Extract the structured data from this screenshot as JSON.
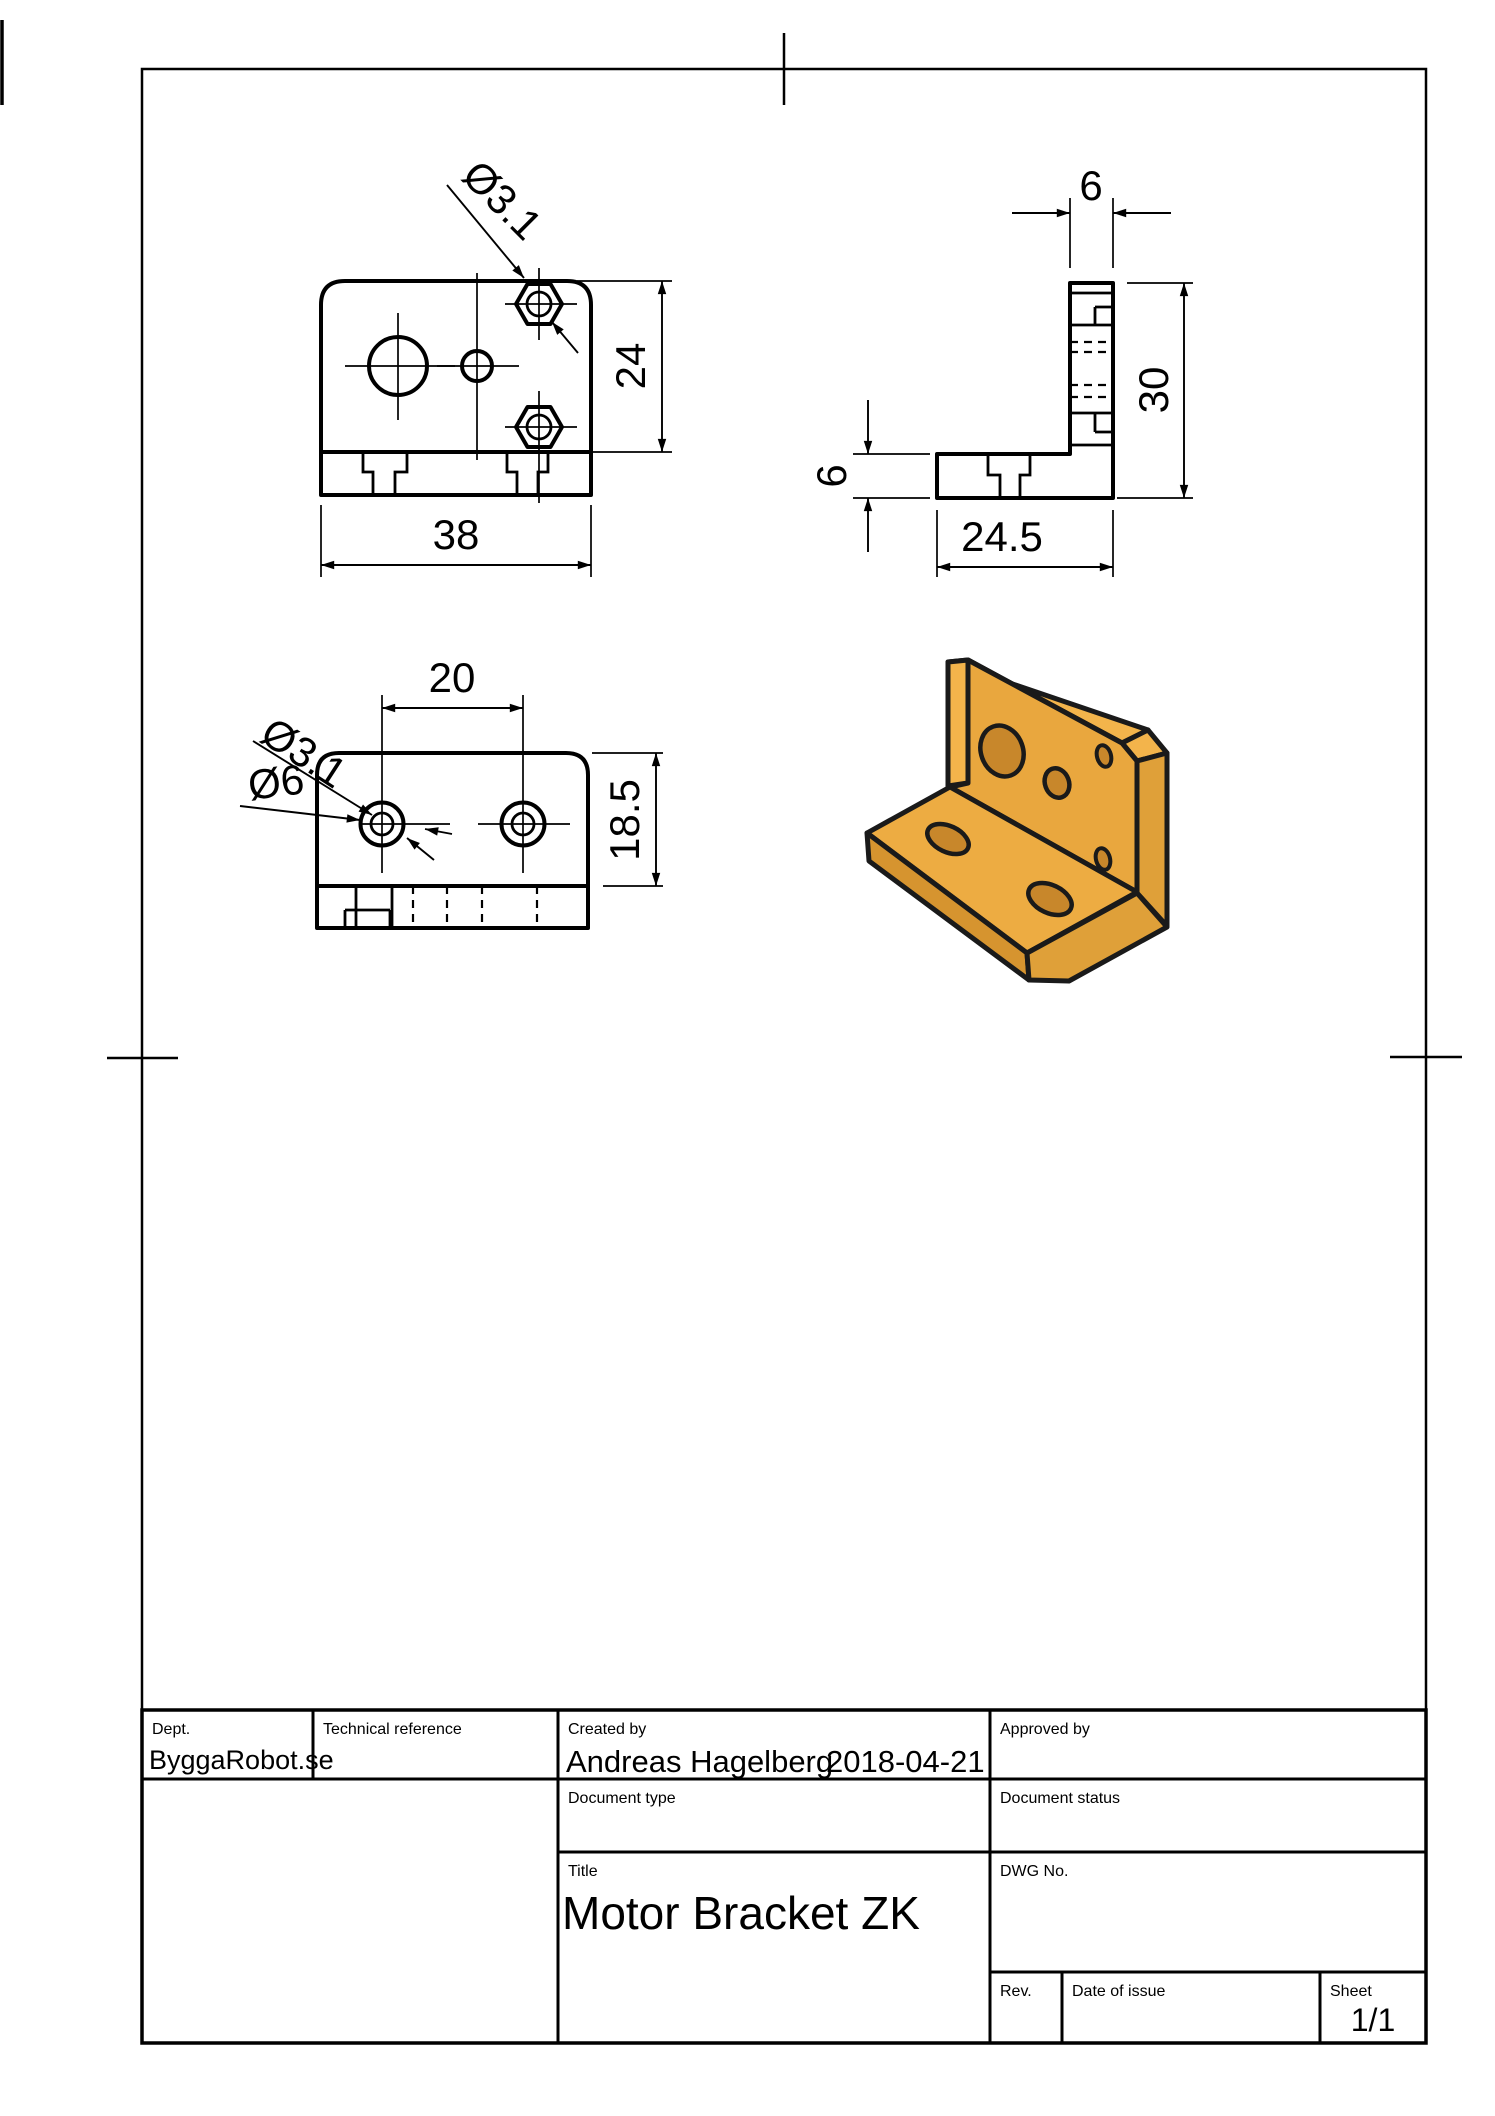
{
  "sheet": {
    "views": {
      "front": {
        "width_dim": "38",
        "height_dim": "24",
        "hole_label": "Ø3.1"
      },
      "side": {
        "top_thickness_dim": "6",
        "height_dim": "30",
        "base_thickness_dim": "6",
        "depth_dim": "24.5"
      },
      "top": {
        "hole_spacing_dim": "20",
        "depth_dim": "18.5",
        "small_hole_label": "Ø3.1",
        "large_hole_label": "Ø6"
      }
    },
    "iso_colors": {
      "face_main": "#E9A73E",
      "face_light": "#F3B44B",
      "face_dark": "#DFA039",
      "face_base": "#EDAC42",
      "band_dark": "#D6942F",
      "hole_inner": "#C8872B",
      "outline": "#1A1A1A"
    }
  },
  "title_block": {
    "dept_label": "Dept.",
    "dept_value": "ByggaRobot.se",
    "technical_reference_label": "Technical reference",
    "created_by_label": "Created by",
    "created_by_name": "Andreas Hagelberg",
    "created_by_date": "2018-04-21",
    "approved_by_label": "Approved by",
    "document_type_label": "Document type",
    "document_status_label": "Document status",
    "title_label": "Title",
    "title_value": "Motor Bracket ZK",
    "dwg_no_label": "DWG No.",
    "rev_label": "Rev.",
    "date_of_issue_label": "Date of issue",
    "sheet_label": "Sheet",
    "sheet_value": "1/1"
  }
}
